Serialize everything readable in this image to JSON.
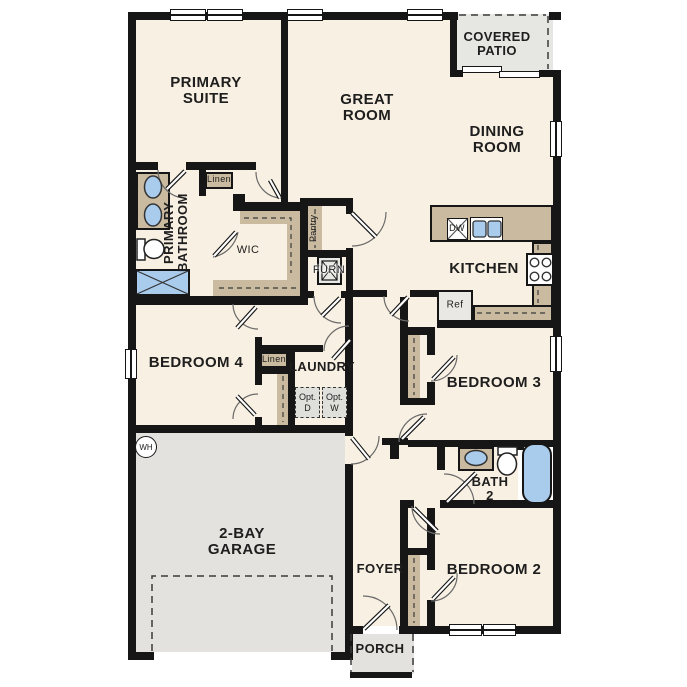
{
  "rooms": {
    "primary_suite": "PRIMARY SUITE",
    "great_room": "GREAT ROOM",
    "dining_room": "DINING ROOM",
    "covered_patio": "COVERED PATIO",
    "kitchen": "KITCHEN",
    "primary_bathroom": "PRIMARY BATHROOM",
    "wic": "WIC",
    "bedroom_4": "BEDROOM 4",
    "laundry": "LAUNDRY",
    "bedroom_3": "BEDROOM 3",
    "bath_2": "BATH 2",
    "bedroom_2": "BEDROOM 2",
    "garage": "2-BAY GARAGE",
    "foyer": "FOYER",
    "porch": "PORCH"
  },
  "labels": {
    "pantry": "Pantry",
    "furnace": "FURN",
    "linen_bath": "Linen",
    "linen_hall": "Linen",
    "dishwasher": "DW",
    "refrigerator": "Ref",
    "water_heater": "WH",
    "opt_dryer": "Opt. D",
    "opt_washer": "Opt. W"
  },
  "colors": {
    "floor": "#f8f0e2",
    "concrete": "#e3e2de",
    "cabinetry": "#c9baa0",
    "fixture_blue": "#a9cbec",
    "wall": "#161616"
  }
}
